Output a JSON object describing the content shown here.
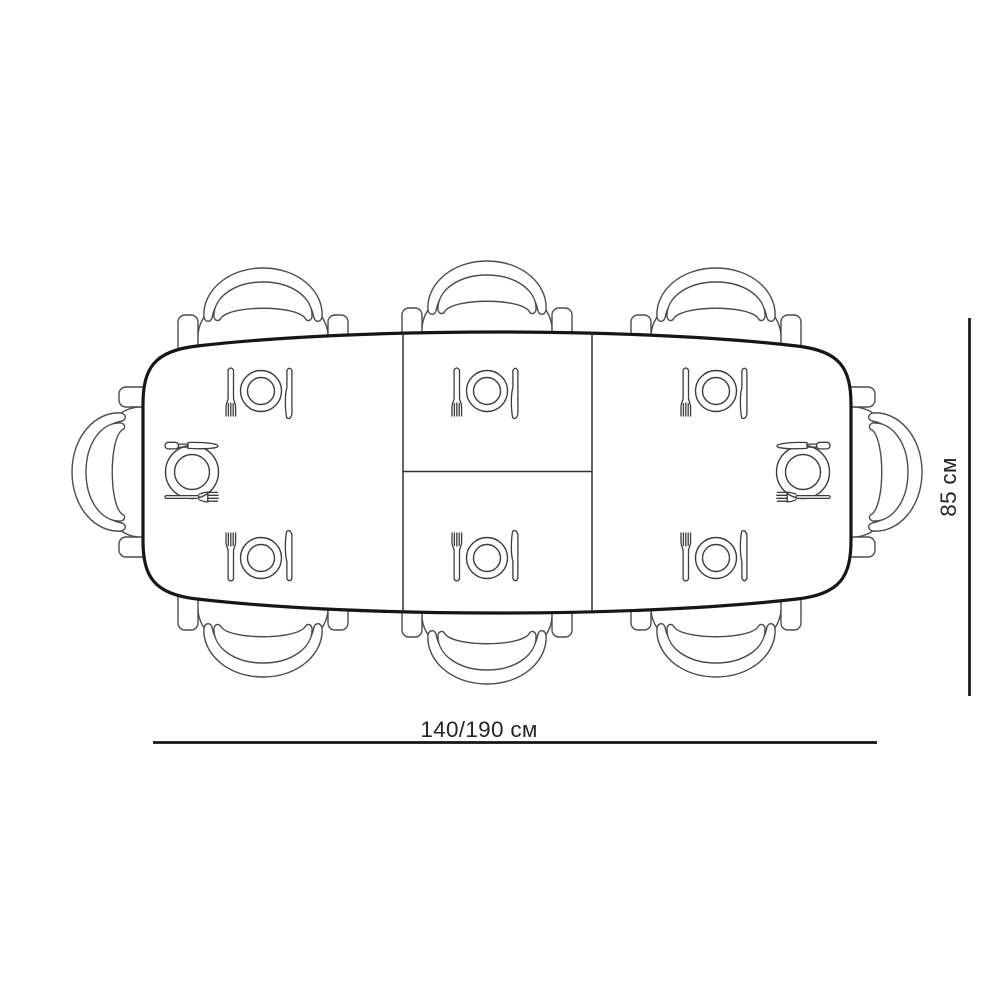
{
  "diagram": {
    "type": "furniture-top-view-plan",
    "subject": "Extendable dining table with 8 chairs and place settings, top view",
    "table": {
      "length_dimension": "140/190 см",
      "width_dimension": "85 см",
      "sections": 3,
      "extension_leaf_parts": 2
    },
    "seats": {
      "top": 3,
      "bottom": 3,
      "left_end": 1,
      "right_end": 1,
      "total": 8
    },
    "place_settings": {
      "count": 8,
      "icons": [
        "fork-icon",
        "plate-icon",
        "knife-icon"
      ]
    },
    "colors": {
      "background": "#ffffff",
      "table_line": "#161616",
      "chair_line": "#4c4c4c",
      "cutlery_line": "#3d3d3d",
      "dimension_line": "#141414",
      "text": "#262626"
    }
  }
}
